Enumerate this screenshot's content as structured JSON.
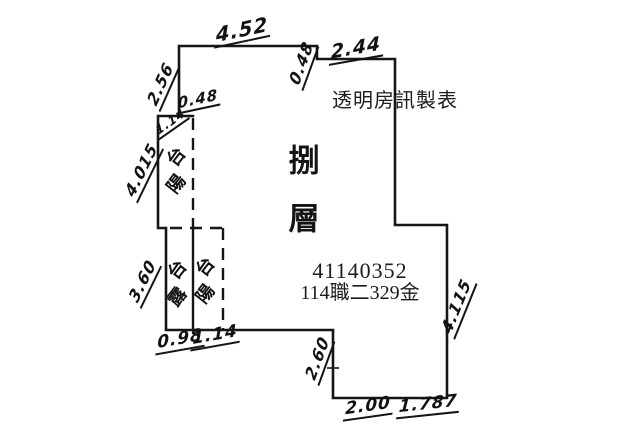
{
  "header": {
    "maker_label": "透明房訊製表"
  },
  "plan": {
    "floor_label": "捌層",
    "case_number": "41140352",
    "case_code": "114職二329金",
    "rooms": {
      "balcony_upper": "陽台",
      "terrace": "露台",
      "balcony_lower": "陽台"
    },
    "measurements": {
      "top_width": "4.52",
      "top_step_depth": "0.48",
      "top_right_width": "2.44",
      "left_upper_height": "2.56",
      "balcony_top_width": "0.48",
      "balcony_top_inner": "1.14",
      "balcony_left_height": "4.015",
      "terrace_left_height": "3.60",
      "terrace_bottom_width": "0.98",
      "balcony_lower_bottom_width": "1.14",
      "bottom_step_height": "2.60",
      "bottom_width_left": "2.00",
      "bottom_width_right": "1.787",
      "right_lower_height": "4.115"
    }
  },
  "colors": {
    "wall_line": "#161616",
    "background": "#ffffff",
    "text": "#121212"
  }
}
